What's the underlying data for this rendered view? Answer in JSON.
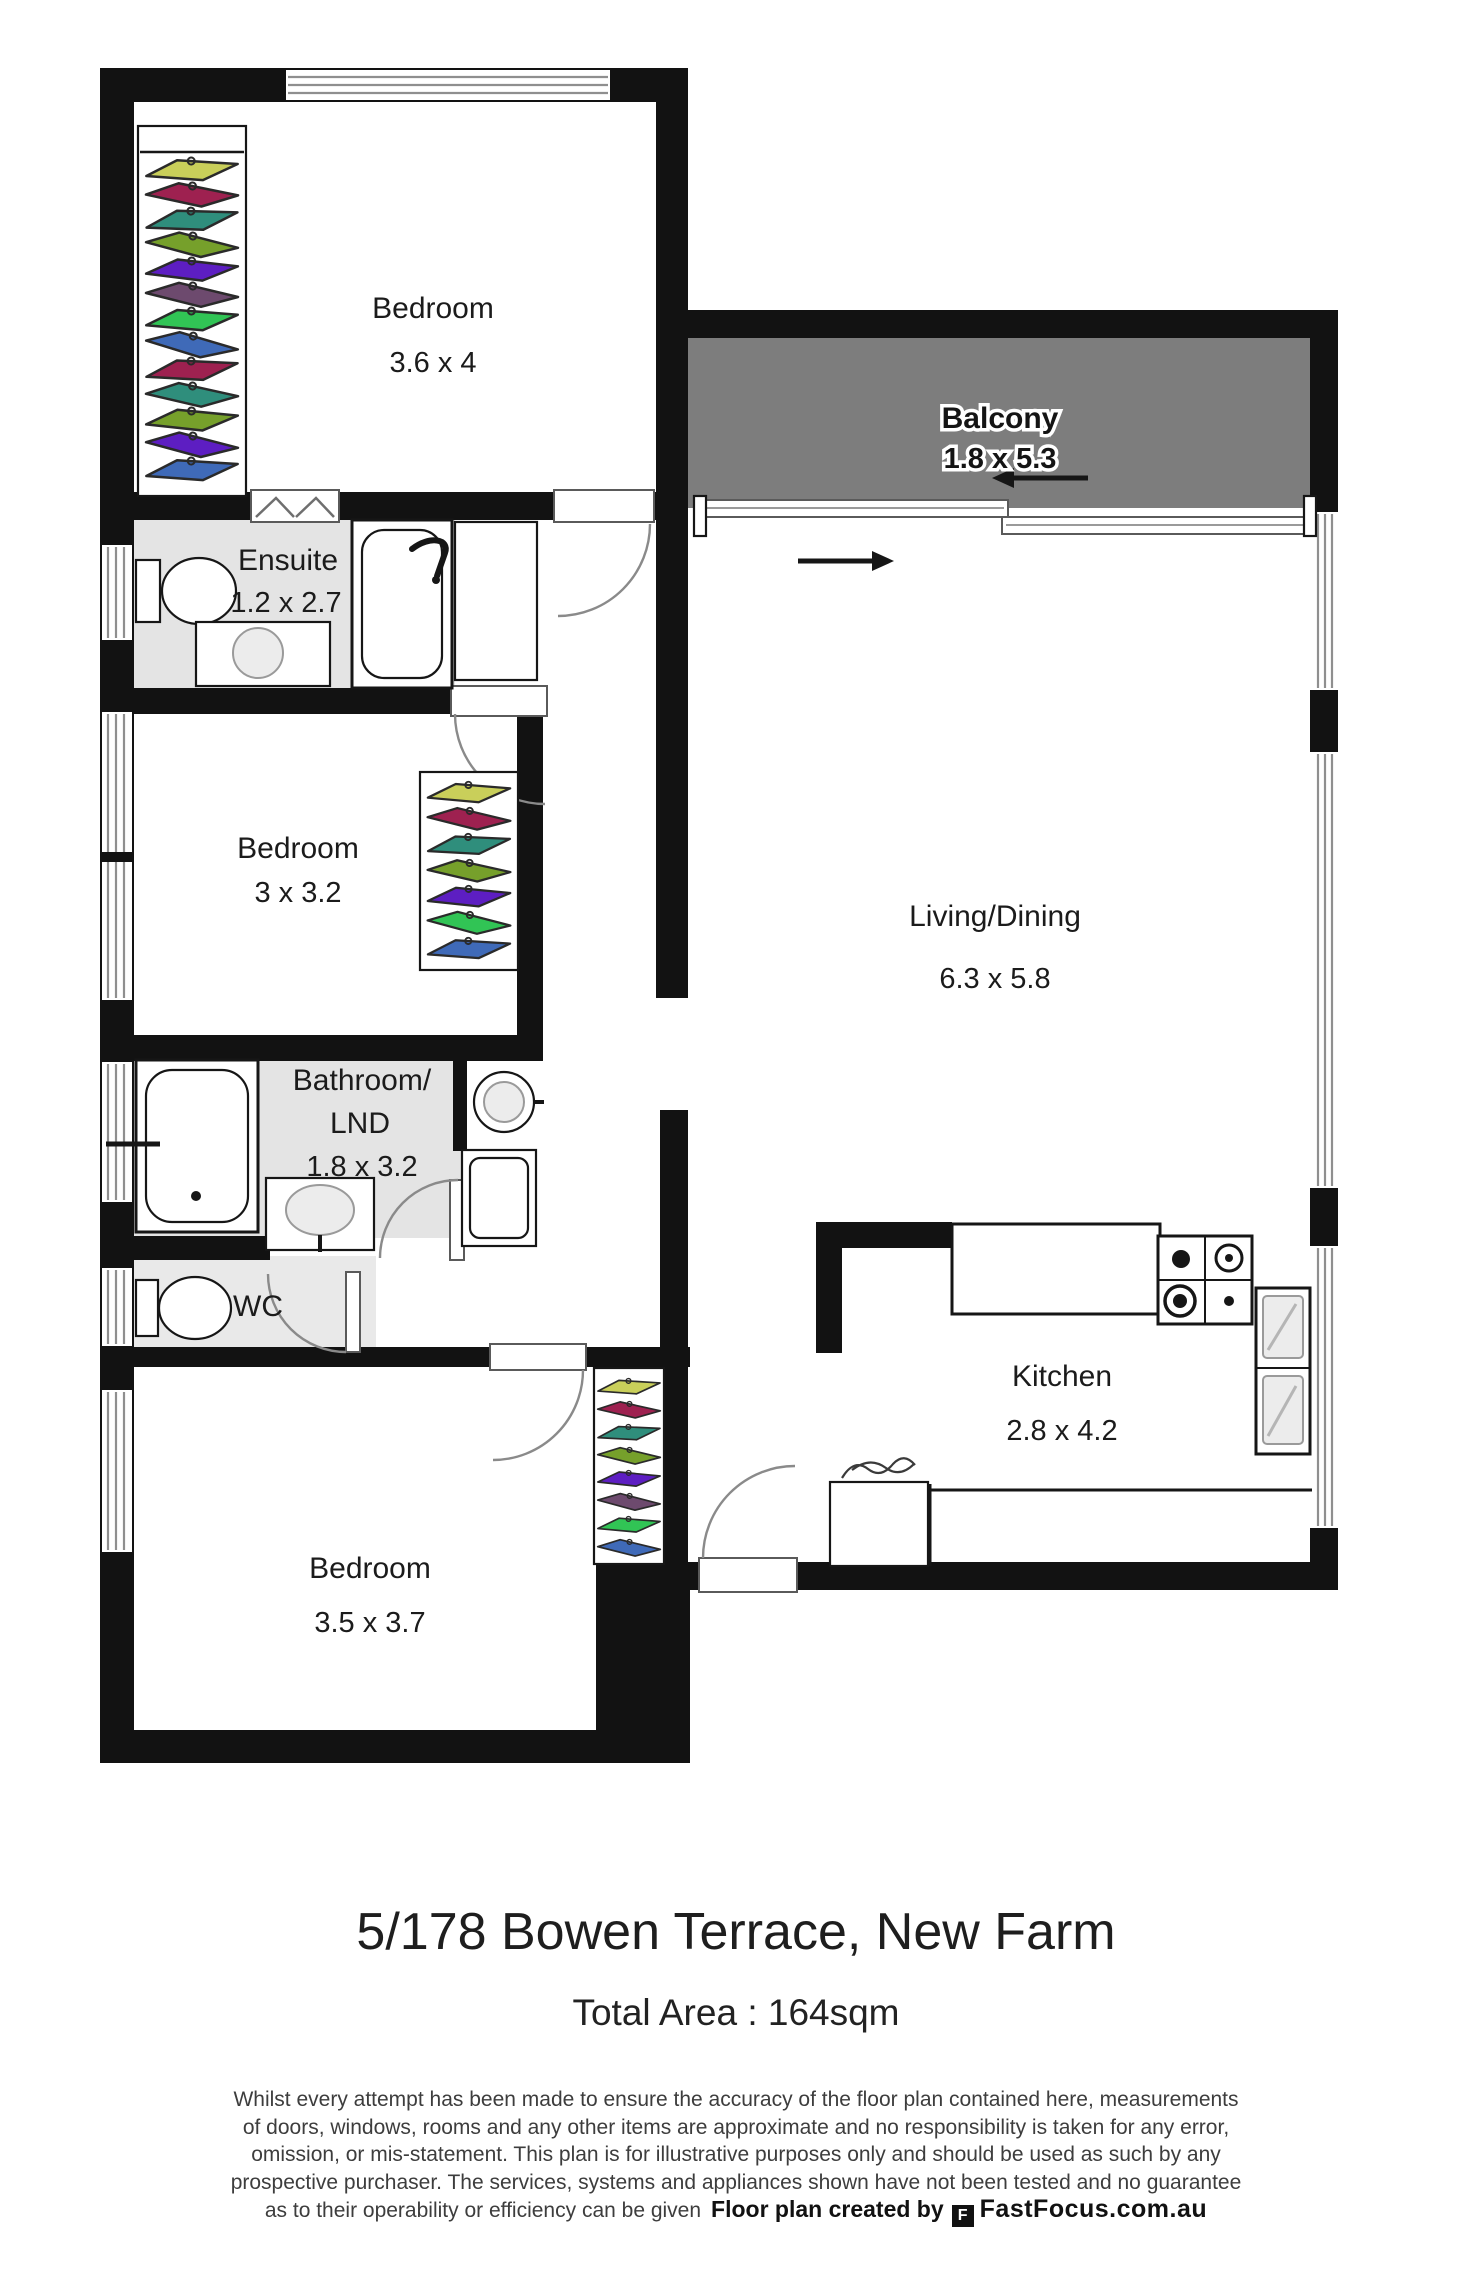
{
  "plan": {
    "colors": {
      "wall": "#121212",
      "balcony_fill": "#7d7d7d",
      "wet_room_fill": "#e4e4e4",
      "hanger_outline": "#2a2a2a"
    },
    "hanger_palette": [
      "#c9cf5a",
      "#9e2150",
      "#2f8e7c",
      "#76a02b",
      "#5d1ec2",
      "#6d4a6e",
      "#31c455",
      "#3f6ab8"
    ],
    "rooms": [
      {
        "id": "bedroom-1",
        "name": "Bedroom",
        "dims": "3.6 x 4"
      },
      {
        "id": "balcony",
        "name": "Balcony",
        "dims": "1.8 x 5.3"
      },
      {
        "id": "ensuite",
        "name": "Ensuite",
        "dims": "1.2 x 2.7"
      },
      {
        "id": "bedroom-2",
        "name": "Bedroom",
        "dims": "3 x 3.2"
      },
      {
        "id": "living-dining",
        "name": "Living/Dining",
        "dims": "6.3 x 5.8"
      },
      {
        "id": "bathroom-laundry",
        "name": "Bathroom/",
        "name_line2": "LND",
        "dims": "1.8 x 3.2"
      },
      {
        "id": "wc",
        "name": "WC"
      },
      {
        "id": "bedroom-3",
        "name": "Bedroom",
        "dims": "3.5 x 3.7"
      },
      {
        "id": "kitchen",
        "name": "Kitchen",
        "dims": "2.8 x 4.2"
      }
    ]
  },
  "footer": {
    "address": "5/178 Bowen Terrace, New Farm",
    "total_area": "Total Area : 164sqm",
    "disclaimer_lines": [
      "Whilst every attempt has been made to ensure the accuracy of the floor plan contained here, measurements",
      "of doors, windows, rooms and any other items are approximate and no responsibility is taken for any error,",
      "omission, or mis-statement. This plan is for illustrative purposes only and should be used as such by any",
      "prospective purchaser. The services, systems and appliances shown have not been tested and no guarantee",
      "as to their operability or efficiency can be given"
    ],
    "credit": {
      "prefix": "Floor plan created by",
      "brand": "FastFocus.com.au",
      "logo_glyph": "F"
    }
  }
}
